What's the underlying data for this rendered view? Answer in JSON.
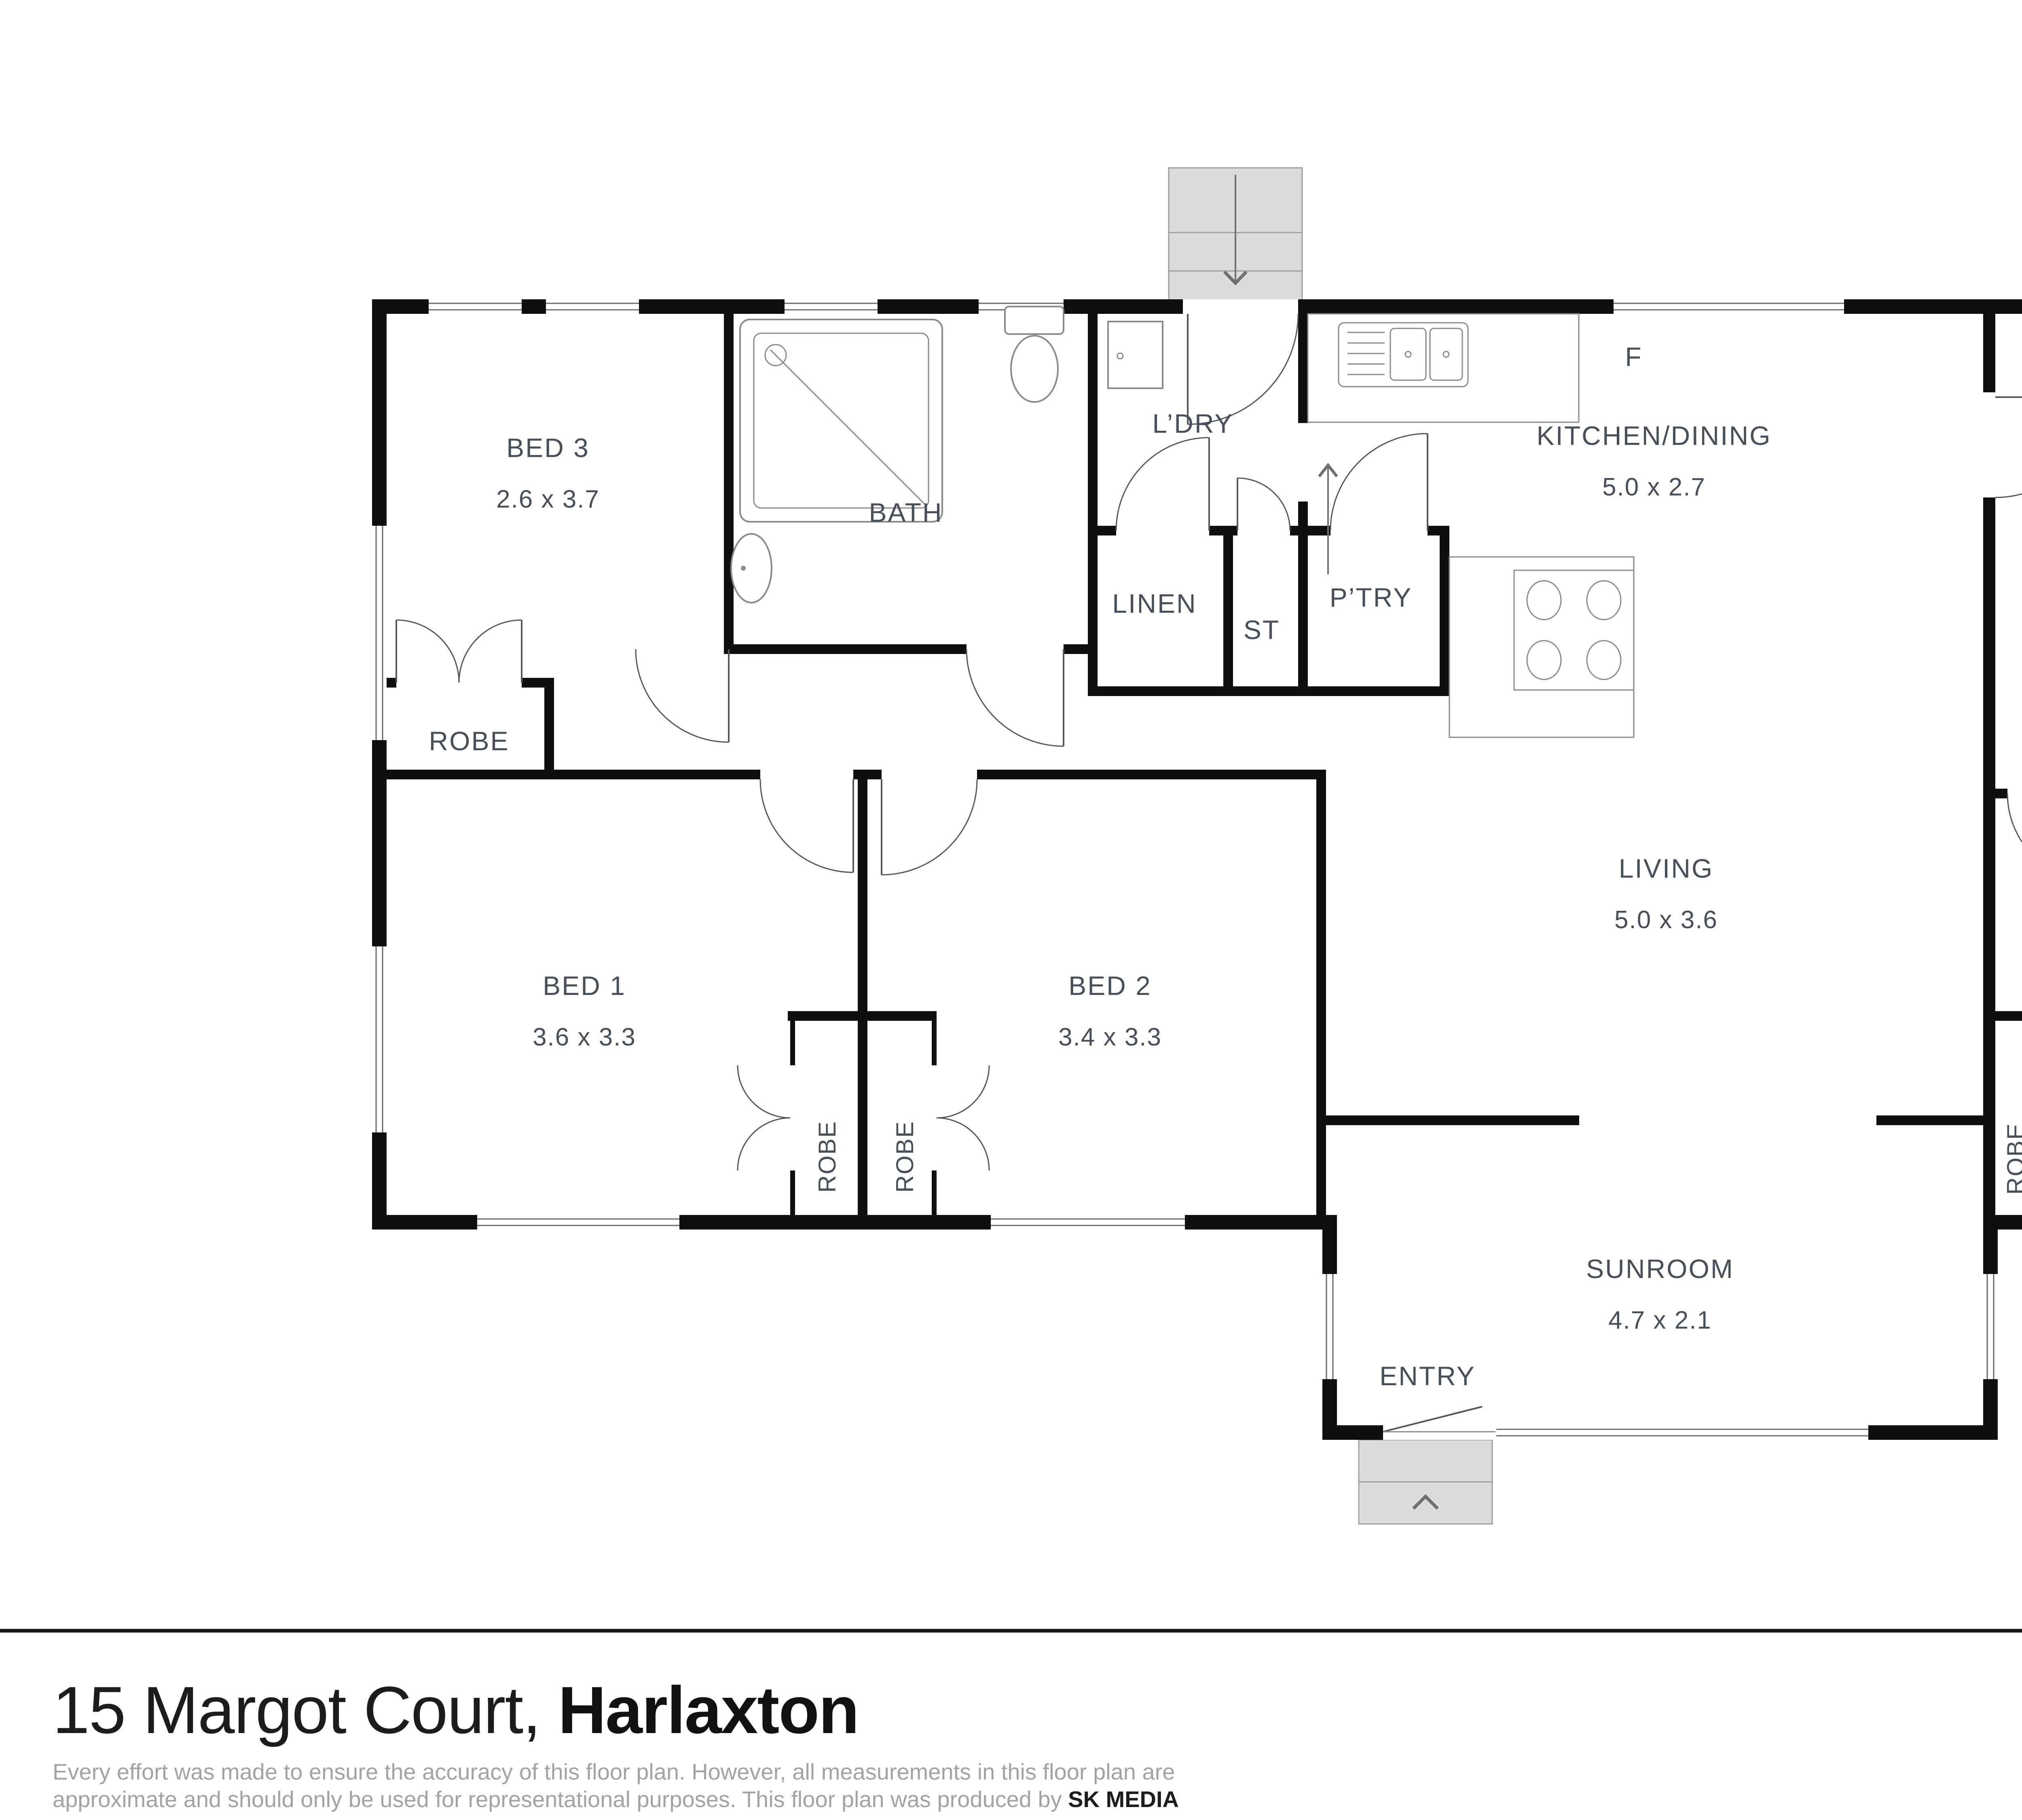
{
  "plan": {
    "rooms": {
      "bed3": {
        "name": "BED 3",
        "dims": "2.6 x 3.7"
      },
      "bath": {
        "name": "BATH"
      },
      "ldry": {
        "name": "L’DRY"
      },
      "linen": {
        "name": "LINEN"
      },
      "st": {
        "name": "ST"
      },
      "ptry": {
        "name": "P’TRY"
      },
      "kitchen": {
        "name": "KITCHEN/DINING",
        "dims": "5.0 x 2.7"
      },
      "fridge": {
        "name": "F"
      },
      "study": {
        "name": "STUDY",
        "dims": "3.0 x 3.5"
      },
      "robe3": {
        "name": "ROBE"
      },
      "bed1": {
        "name": "BED 1",
        "dims": "3.6 x 3.3"
      },
      "bed2": {
        "name": "BED 2",
        "dims": "3.4 x 3.3"
      },
      "robe1": {
        "name": "ROBE"
      },
      "robe2": {
        "name": "ROBE"
      },
      "living": {
        "name": "LIVING",
        "dims": "5.0 x 3.6"
      },
      "bed4": {
        "name": "BED 4",
        "dims": "3.0 x 3.5"
      },
      "robe4": {
        "name": "ROBE"
      },
      "sunroom": {
        "name": "SUNROOM",
        "dims": "4.7 x 2.1"
      },
      "entry": {
        "name": "ENTRY"
      }
    },
    "wall_color": "#101010",
    "label_color": "#47505a"
  },
  "footer": {
    "address_light": "15 Margot Court, ",
    "address_bold": "Harlaxton",
    "disclaimer_line1": "Every effort was made to ensure the accuracy of this floor plan. However, all measurements in this floor plan are",
    "disclaimer_line2_pre": "approximate and should only be used for representational purposes. This floor plan was produced by ",
    "disclaimer_producer": "SK MEDIA",
    "brand": {
      "wordmark": "CENTURY 21.",
      "reg": "®",
      "tagline": "The Garden City",
      "gold": "#b7a176",
      "navy": "#1f2a44"
    },
    "compass_letter": "N"
  }
}
